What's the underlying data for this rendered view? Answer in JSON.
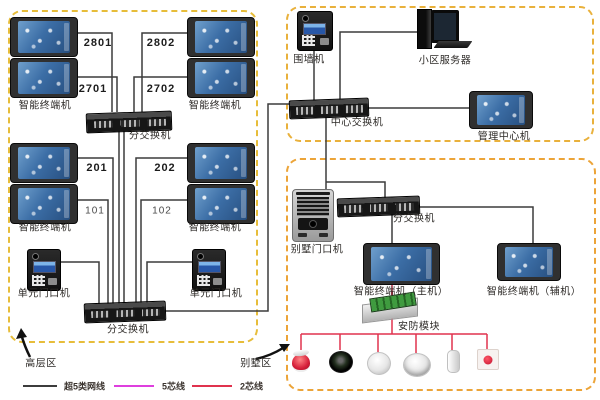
{
  "highrise_zone": {
    "zone_label": "高层区",
    "terminal_label": "智能终端机",
    "door_station_label": "单元门口机",
    "switch_label": "分交换机",
    "unit_numbers": [
      "2801",
      "2802",
      "2701",
      "2702",
      "201",
      "202",
      "101",
      "102"
    ]
  },
  "management_zone": {
    "wall_station_label": "围墙机",
    "server_label": "小区服务器",
    "switch_label": "中心交换机",
    "management_terminal_label": "管理中心机"
  },
  "villa_zone": {
    "zone_label": "别墅区",
    "door_station_label": "别墅门口机",
    "switch_label": "分交换机",
    "master_terminal_label": "智能终端机（主机）",
    "aux_terminal_label": "智能终端机（辅机）",
    "security_module_label": "安防模块",
    "sensor_icons": [
      "alarm-siren",
      "gas-detector",
      "smoke-detector",
      "heat-detector",
      "door-contact",
      "panic-button"
    ]
  },
  "legend": {
    "cat5e": {
      "label": "超5类网线",
      "color": "#3c3c3c"
    },
    "wire5": {
      "label": "5芯线",
      "color": "#de3fde"
    },
    "wire2": {
      "label": "2芯线",
      "color": "#e0324e"
    }
  }
}
